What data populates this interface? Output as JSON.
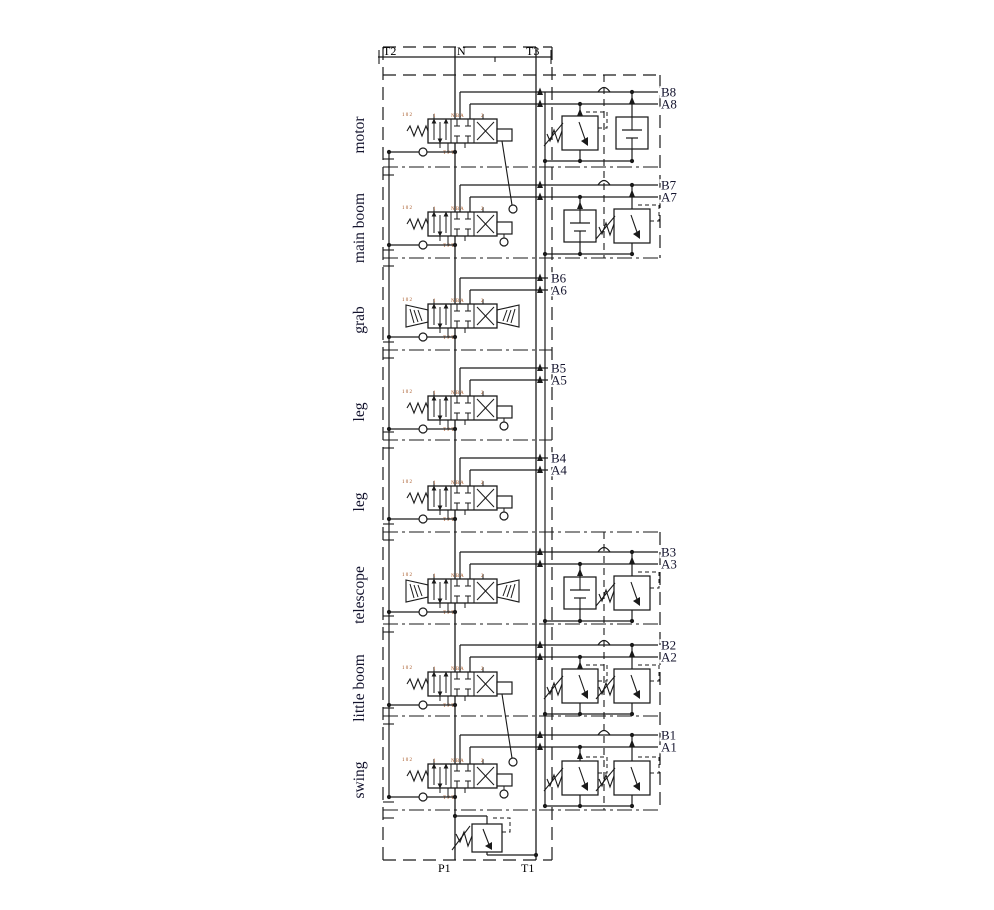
{
  "diagram_title": "sectional directional control valve hydraulic schematic",
  "ports": {
    "t2": "T2",
    "n": "N",
    "t3": "T3",
    "p1": "P1",
    "t1": "T1"
  },
  "sections": [
    {
      "name": "motor",
      "work_ports": [
        "B8",
        "A8"
      ],
      "spring": "left",
      "lever": "long",
      "components": [
        "pilot-relief-valve",
        "check-valve"
      ]
    },
    {
      "name": "main boom",
      "work_ports": [
        "B7",
        "A7"
      ],
      "spring": "left",
      "lever": "pendant",
      "components": [
        "check-valve",
        "pilot-relief-valve"
      ]
    },
    {
      "name": "grab",
      "work_ports": [
        "B6",
        "A6"
      ],
      "spring": "both",
      "lever": "none",
      "components": []
    },
    {
      "name": "leg",
      "work_ports": [
        "B5",
        "A5"
      ],
      "spring": "left",
      "lever": "pendant",
      "components": []
    },
    {
      "name": "leg",
      "work_ports": [
        "B4",
        "A4"
      ],
      "spring": "left",
      "lever": "pendant",
      "components": []
    },
    {
      "name": "telescope",
      "work_ports": [
        "B3",
        "A3"
      ],
      "spring": "both",
      "lever": "none",
      "components": [
        "check-valve",
        "pilot-relief-valve"
      ]
    },
    {
      "name": "little boom",
      "work_ports": [
        "B2",
        "A2"
      ],
      "spring": "left",
      "lever": "long",
      "components": [
        "pilot-relief-valve",
        "pilot-relief-valve"
      ]
    },
    {
      "name": "swing",
      "work_ports": [
        "B1",
        "A1"
      ],
      "spring": "left",
      "lever": "pendant",
      "components": [
        "pilot-relief-valve",
        "pilot-relief-valve"
      ]
    }
  ],
  "main_relief_valve": {
    "type": "pilot-relief-valve",
    "between": [
      "P1",
      "T1"
    ]
  },
  "valve_markings": {
    "left": "1 0 2",
    "top_left": "1",
    "top_center": "N B A",
    "top_right": "2",
    "bottom": "T P T"
  },
  "colors": {
    "line": "#1a1a1a",
    "text": "#14142e",
    "marking": "#a3511e",
    "background": "#ffffff"
  }
}
